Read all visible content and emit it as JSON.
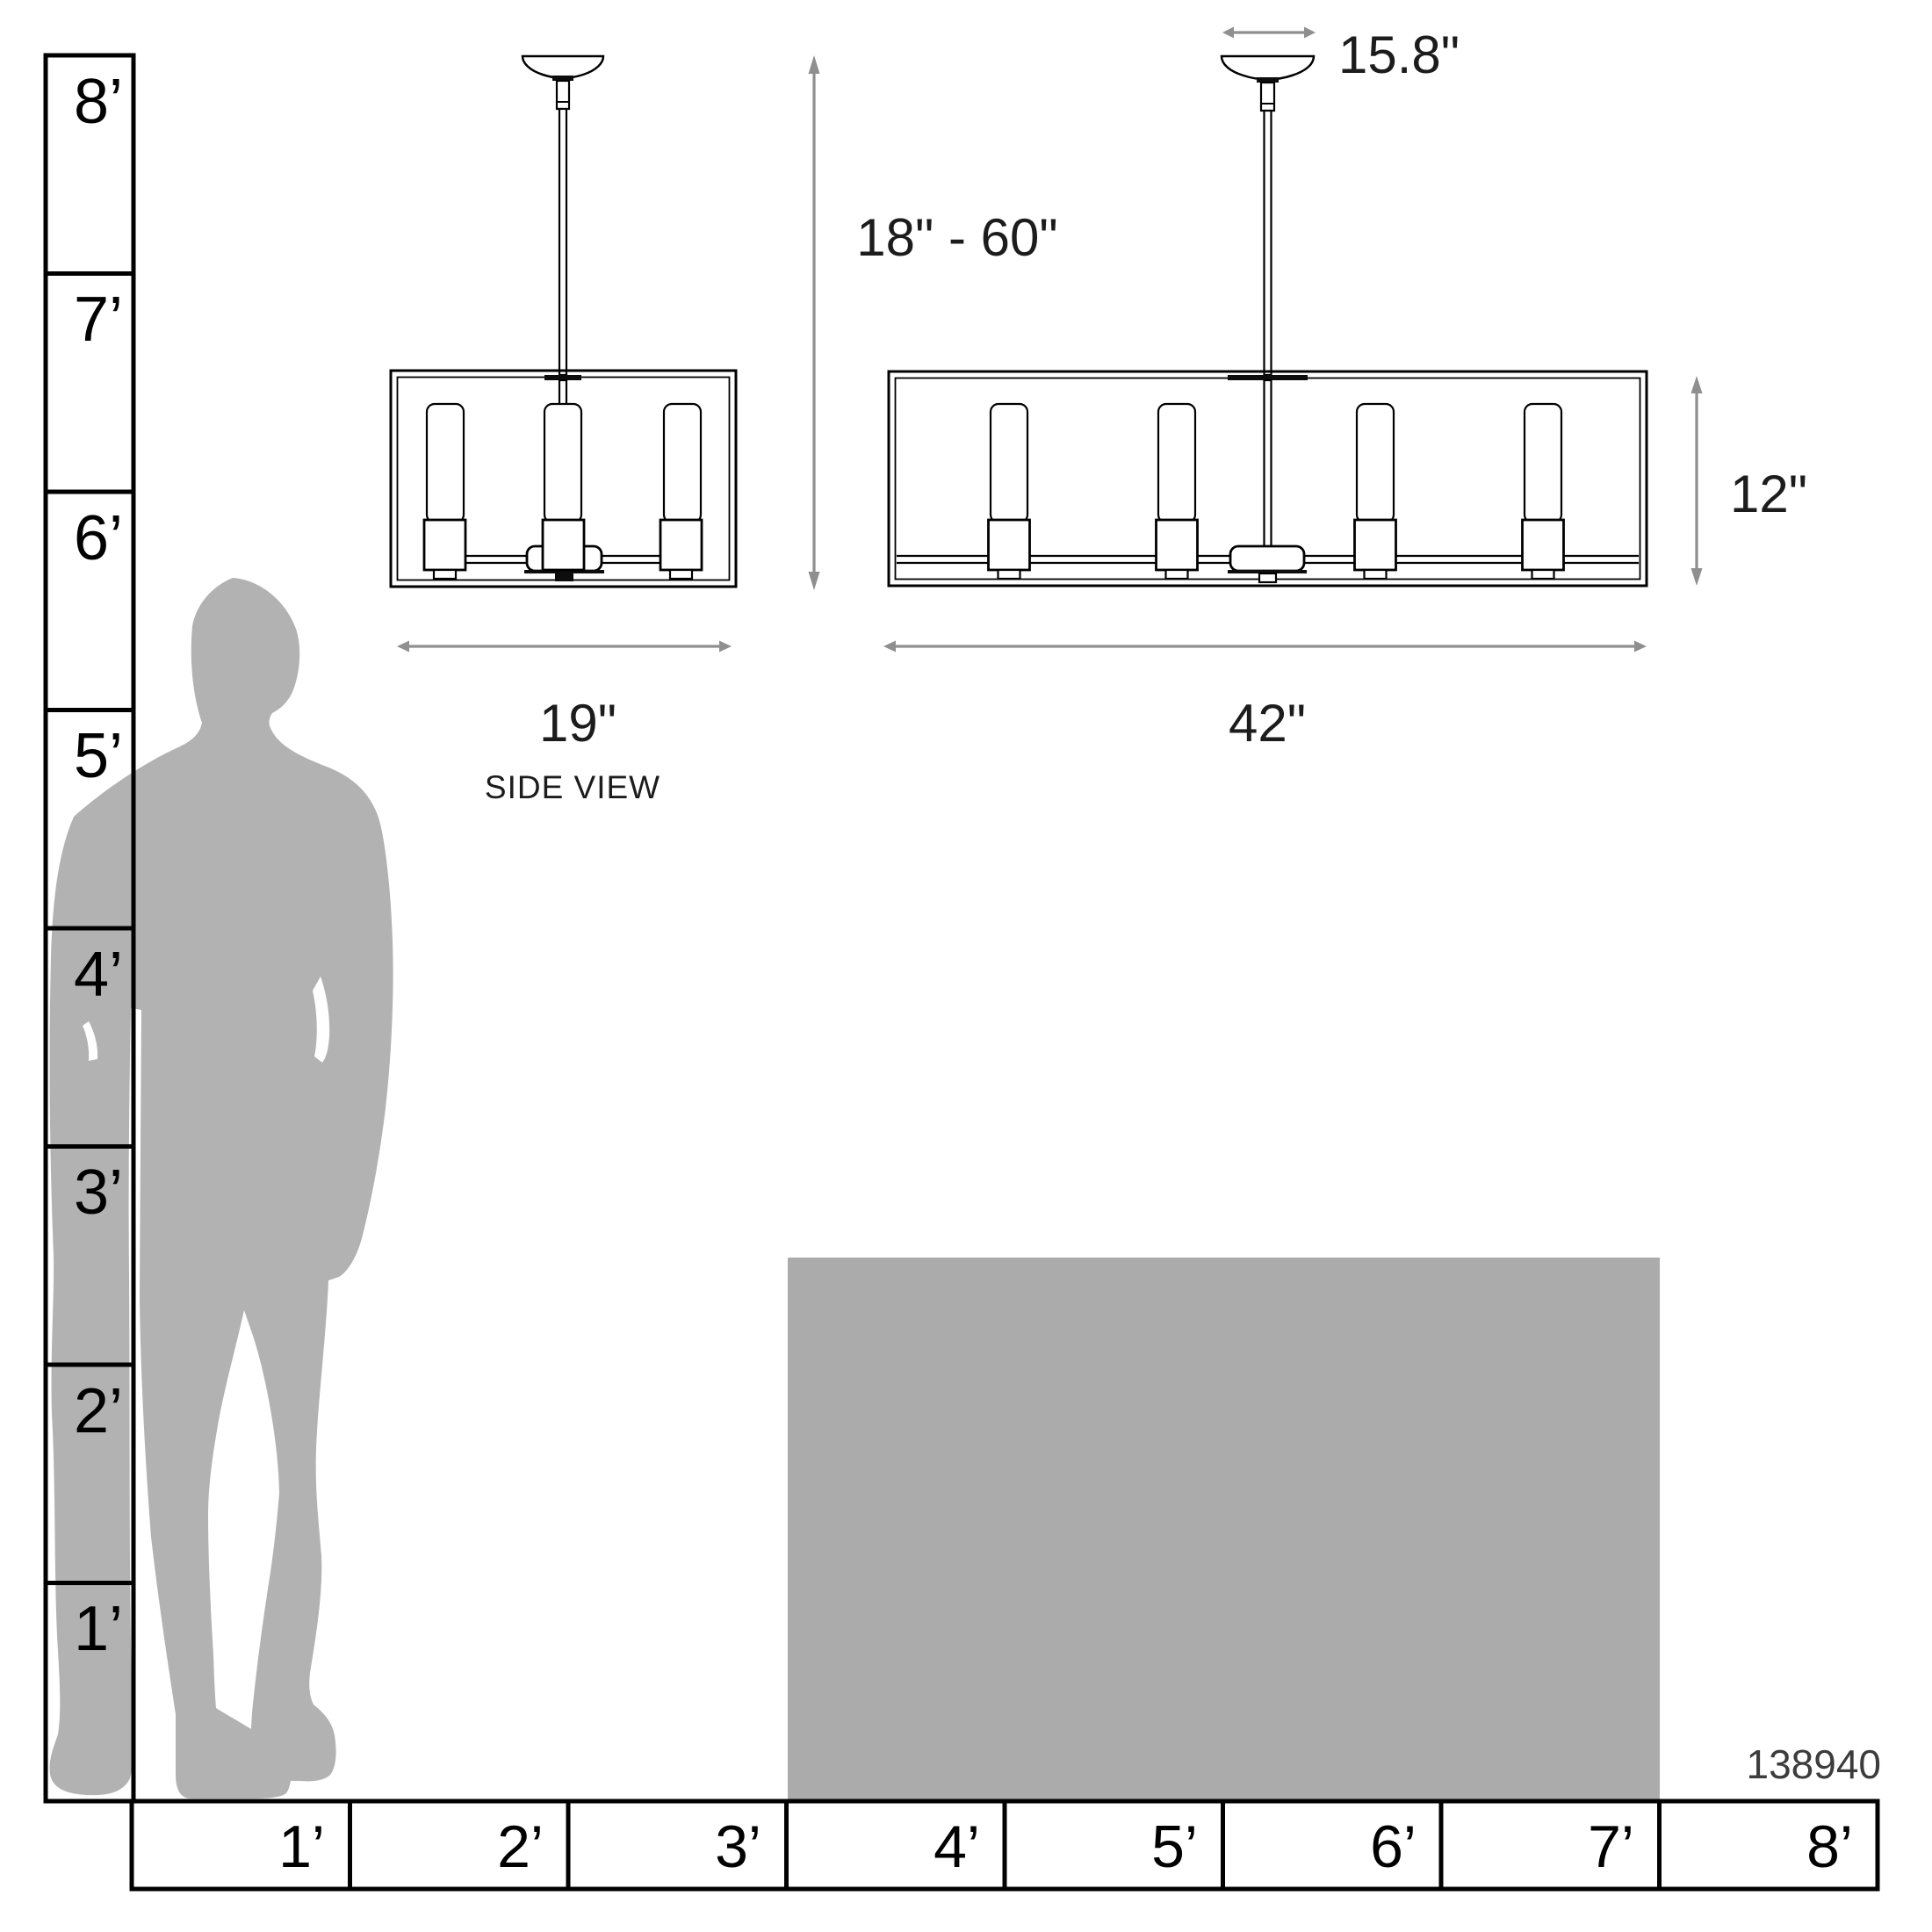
{
  "product": {
    "model_number": "138940"
  },
  "dimensions": {
    "canopy_width": "15.8\"",
    "hanging_height_range": "18\" - 60\"",
    "fixture_height": "12\"",
    "fixture_depth": "19\"",
    "fixture_width": "42\"",
    "side_view_caption": "SIDE VIEW"
  },
  "rulers": {
    "vertical_feet": [
      "8’",
      "7’",
      "6’",
      "5’",
      "4’",
      "3’",
      "2’",
      "1’"
    ],
    "horizontal_feet": [
      "1’",
      "2’",
      "3’",
      "4’",
      "5’",
      "6’",
      "7’",
      "8’"
    ]
  },
  "colors": {
    "silhouette": "#b2b2b2",
    "table": "#ababab",
    "dimension_arrow": "#8f8f8f",
    "line_art": "#000000"
  }
}
